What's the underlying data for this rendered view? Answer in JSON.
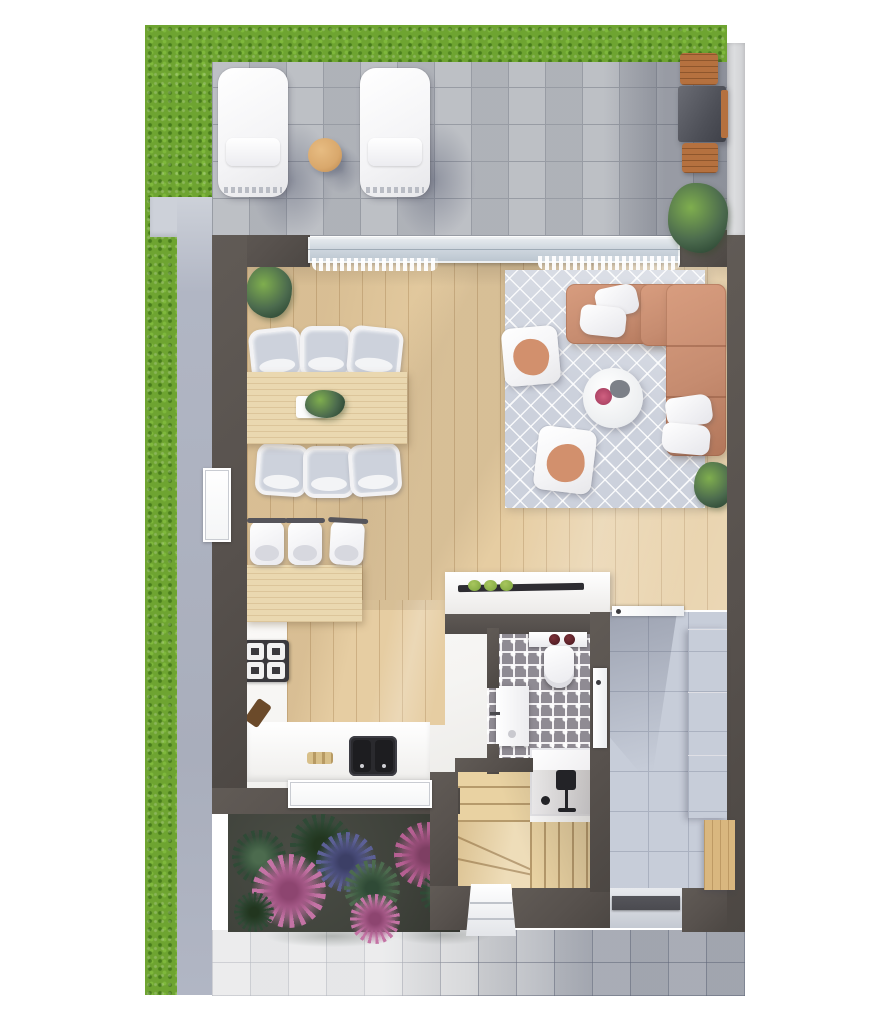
{
  "scene": {
    "type": "3d-floor-plan-top-view",
    "width_px": 874,
    "height_px": 1024,
    "background": "#ffffff"
  },
  "palette": {
    "grass": "#6ea431",
    "path": "#b1b6c4",
    "path_cap": "#cdd1d9",
    "patio_tile": "#b8bbc1",
    "patio_grout": "#989ca4",
    "neighbor_wall": "#dcdddf",
    "wall": "#57514d",
    "wood": "#e6cda2",
    "table_wood": "#ead8b0",
    "stairs_wood": "#e9d2a2",
    "bench_wood": "#d9b77f",
    "outdoor_wood": "#b5713f",
    "rug": "#ccd1dc",
    "sofa": "#c68c70",
    "sofa_dark": "#b2765a",
    "pillow": "#f5f5f7",
    "chair_gray": "#cdd2dc",
    "white_furn": "#f4f4f6",
    "counter": "#f5f4f2",
    "island_face": "#514c49",
    "hob": "#2e2d32",
    "jar_green": "#7aa33c",
    "sink_dark": "#1d1d20",
    "stove_dark": "#3a393d",
    "hall_tile": "#c7cdd9",
    "hall_grout": "#aab1c0",
    "bath_tile": "#8f8b93",
    "shower_floor": "#f1f0f2",
    "fixture_black": "#232327",
    "soil": "#3f423b",
    "flower_pink": "#c473a5",
    "flower_magenta": "#b55f92",
    "flower_purple": "#5c6096",
    "leaf_dark": "#2f4a36",
    "leaf_mid": "#4c6b4e",
    "leaf_bright": "#7fae4e",
    "pave_light": "#d6d7d9",
    "pave_dark": "#9aa0ae",
    "glass": "#cfd7df",
    "door_dark": "#4b4b50",
    "terracotta": "#d2906d",
    "wardrobe_white": "#f6f6f8",
    "window_white": "#f4f5f6"
  },
  "outdoor": {
    "garden": {
      "lawn_strips": 2,
      "walkway": 1,
      "flower_bed_plants": 9
    },
    "patio": {
      "sun_loungers": 2,
      "round_side_table": 1
    },
    "terrace_right": {
      "wood_chairs": 2,
      "grill_table": 1,
      "potted_plant": 1
    },
    "entry": {
      "front_door": 1,
      "entry_step": 1,
      "pavement": 1
    }
  },
  "interior": {
    "living_room": {
      "sofa_sections": 2,
      "throw_pillows": 4,
      "armchairs": 2,
      "coffee_table": 1,
      "area_rug": 1,
      "plants": 2
    },
    "dining_area": {
      "table": 1,
      "chairs": 6,
      "centerpiece_plant": 1,
      "corner_plant": 1
    },
    "kitchen": {
      "bar_counter": 1,
      "bar_stools": 3,
      "cooktop_burners": 4,
      "island": 1,
      "island_jars": 3,
      "double_sink": 1
    },
    "bathroom": {
      "toilet": 1,
      "washbasin": 1,
      "vanity": 1,
      "shower": 1
    },
    "hallway": {
      "wardrobe": 1,
      "shoe_bench": 1,
      "interior_doors": 2
    },
    "staircase": {
      "straight_treads": 7,
      "winder_treads": 3
    }
  }
}
